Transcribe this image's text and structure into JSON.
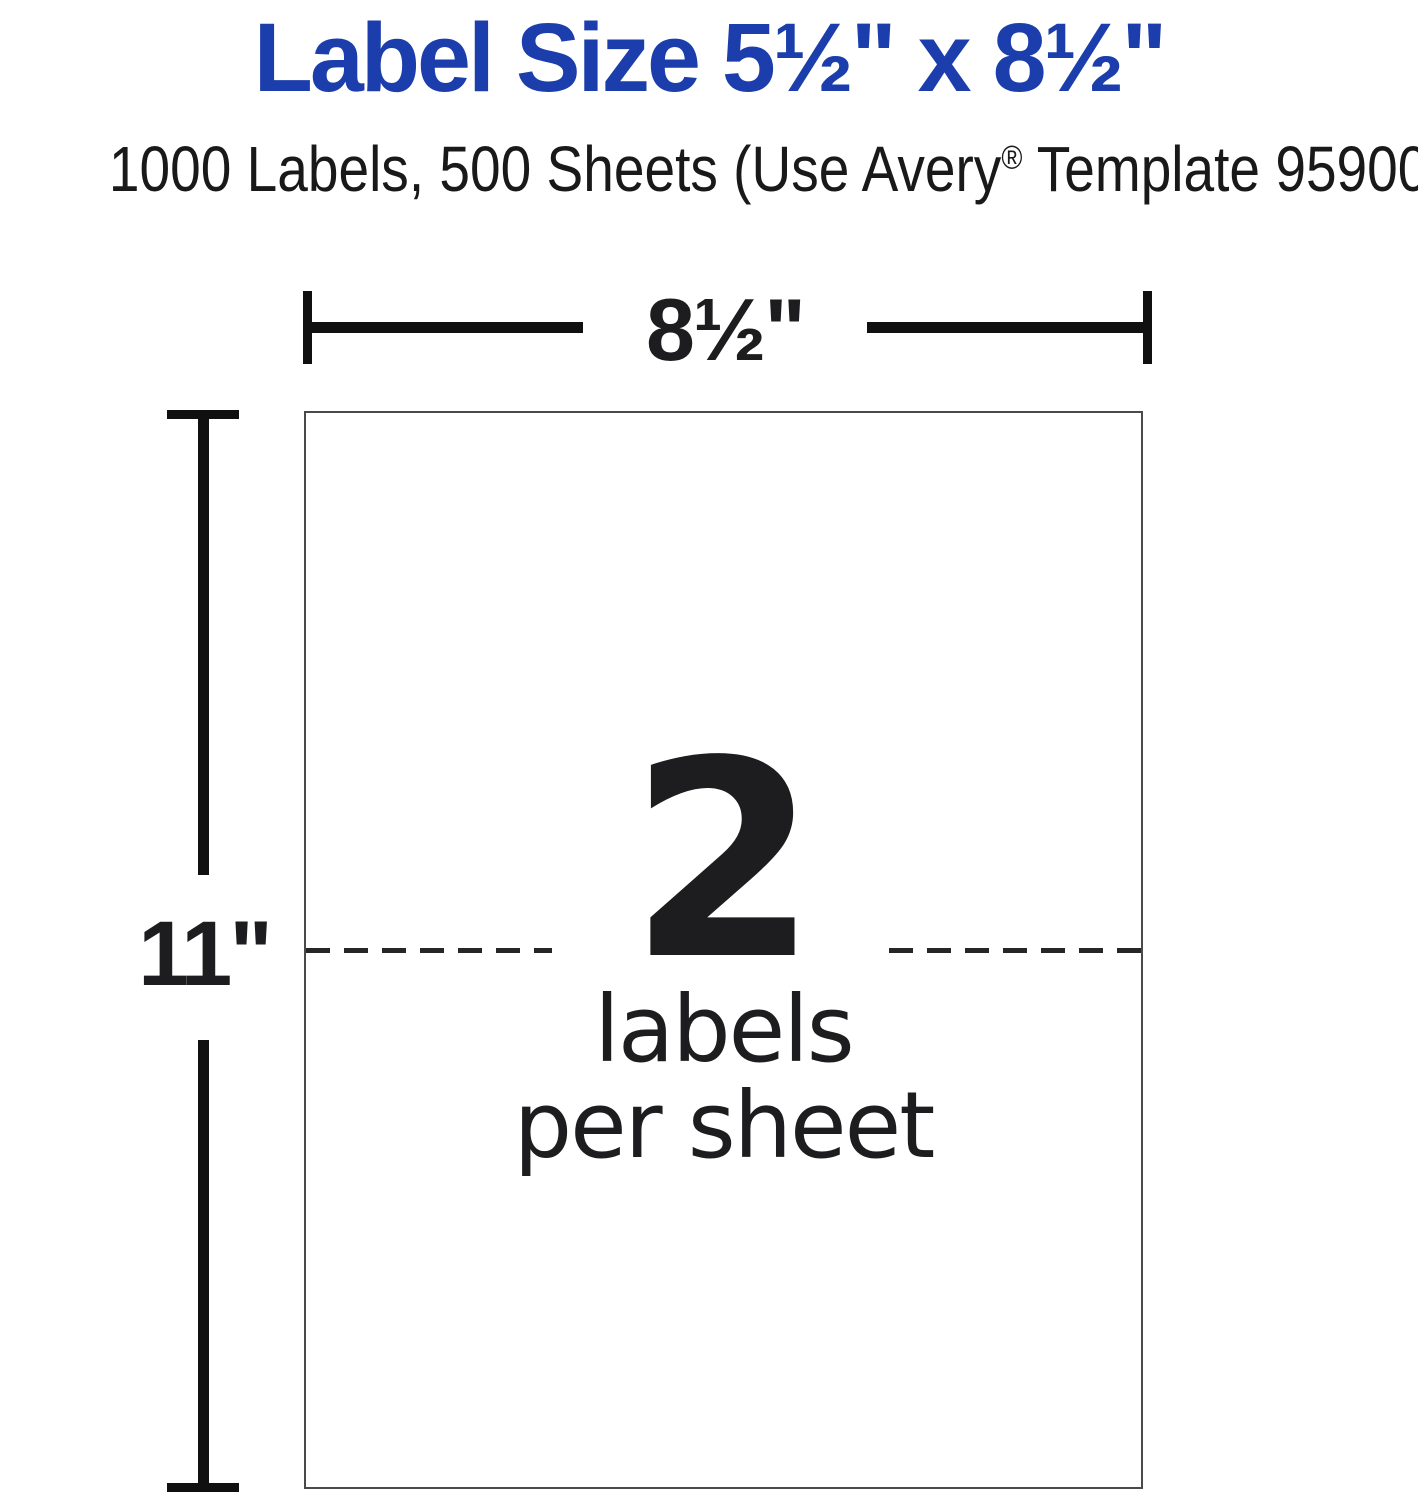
{
  "header": {
    "title": "Label Size 5½\" x 8½\"",
    "subtitle_pre": "1000 Labels, 500 Sheets (Use Avery",
    "subtitle_reg": "®",
    "subtitle_post": " Template 95900)"
  },
  "diagram": {
    "sheet_width_label": "8½\"",
    "sheet_height_label": "11\"",
    "labels_per_sheet_count": "2",
    "caption_line1": "labels",
    "caption_line2": "per sheet"
  },
  "colors": {
    "title_blue": "#1B3EAC",
    "ink": "#1d1d1f",
    "dimension_line": "#101010",
    "sheet_border": "#4a4a4a"
  }
}
